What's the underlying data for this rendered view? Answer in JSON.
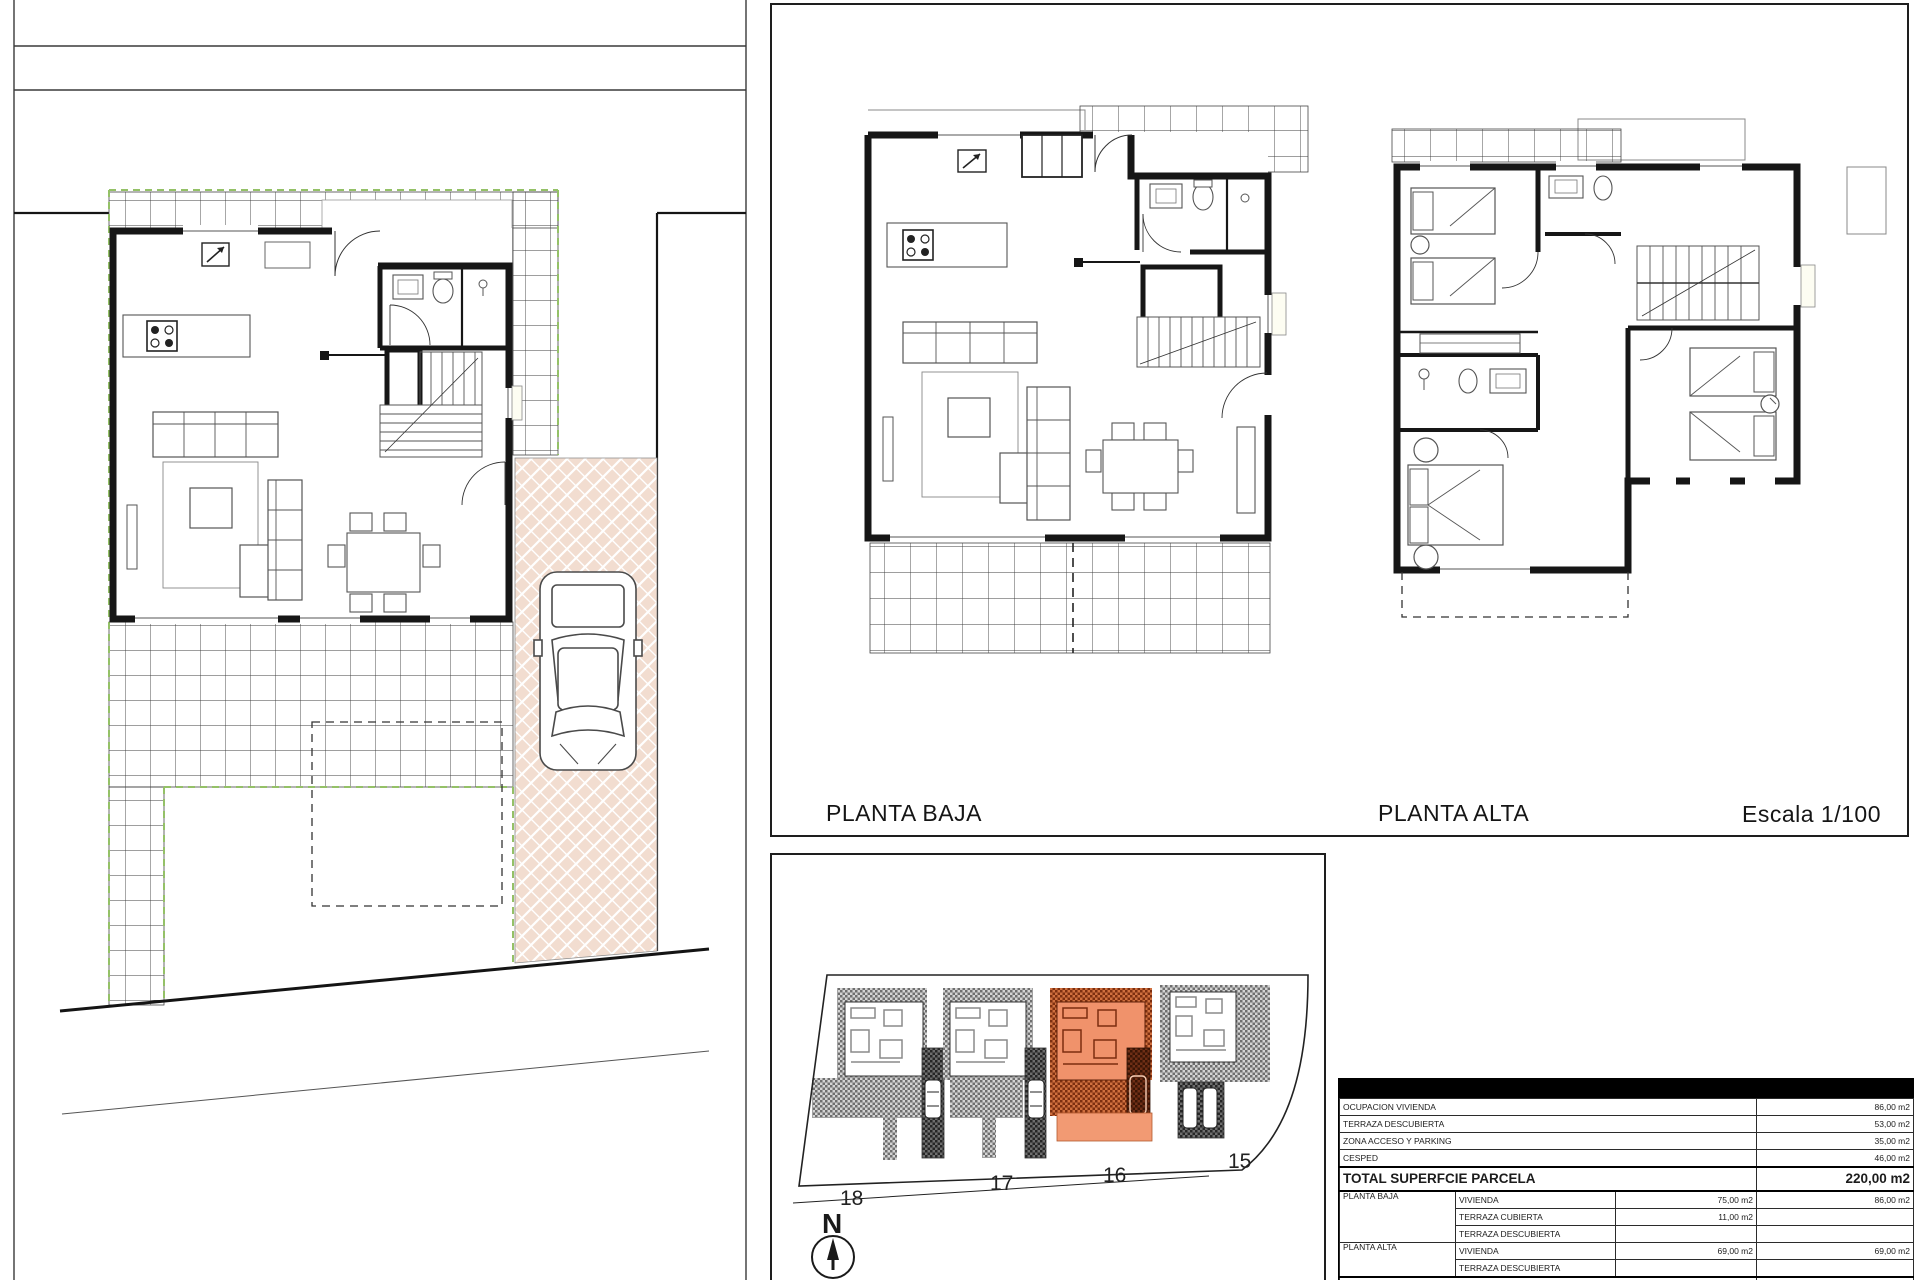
{
  "floor_plans_panel": {
    "planta_baja_label": "PLANTA BAJA",
    "planta_alta_label": "PLANTA ALTA",
    "scale_label": "Escala 1/100"
  },
  "site_layout_panel": {
    "north_label": "N",
    "lot_numbers": [
      "18",
      "17",
      "16",
      "15"
    ]
  },
  "areas_table": {
    "parcel_rows": [
      {
        "label": "OCUPACION VIVIENDA",
        "total": "86,00 m2"
      },
      {
        "label": "TERRAZA DESCUBIERTA",
        "total": "53,00 m2"
      },
      {
        "label": "ZONA ACCESO Y PARKING",
        "total": "35,00 m2"
      },
      {
        "label": "CESPED",
        "total": "46,00 m2"
      }
    ],
    "total_parcela_label": "TOTAL SUPERFCIE PARCELA",
    "total_parcela_value": "220,00 m2",
    "floor_rows": [
      {
        "floor": "PLANTA BAJA",
        "concept": "VIVIENDA",
        "partial": "75,00 m2",
        "total": "86,00 m2"
      },
      {
        "floor": "",
        "concept": "TERRAZA CUBIERTA",
        "partial": "11,00 m2",
        "total": ""
      },
      {
        "floor": "",
        "concept": "TERRAZA DESCUBIERTA",
        "partial": "",
        "total": ""
      },
      {
        "floor": "PLANTA ALTA",
        "concept": "VIVIENDA",
        "partial": "69,00 m2",
        "total": "69,00 m2"
      },
      {
        "floor": "",
        "concept": "TERRAZA DESCUBIERTA",
        "partial": "",
        "total": ""
      }
    ],
    "total_vivienda_label": "TOTAL SUPERFICIE VIVIENDA",
    "total_vivienda_value": "155,00 m2"
  },
  "colors": {
    "highlight_orange": "#ef8e63",
    "green_dash": "#94c167",
    "herringbone_paving": "#f2ddd0"
  }
}
